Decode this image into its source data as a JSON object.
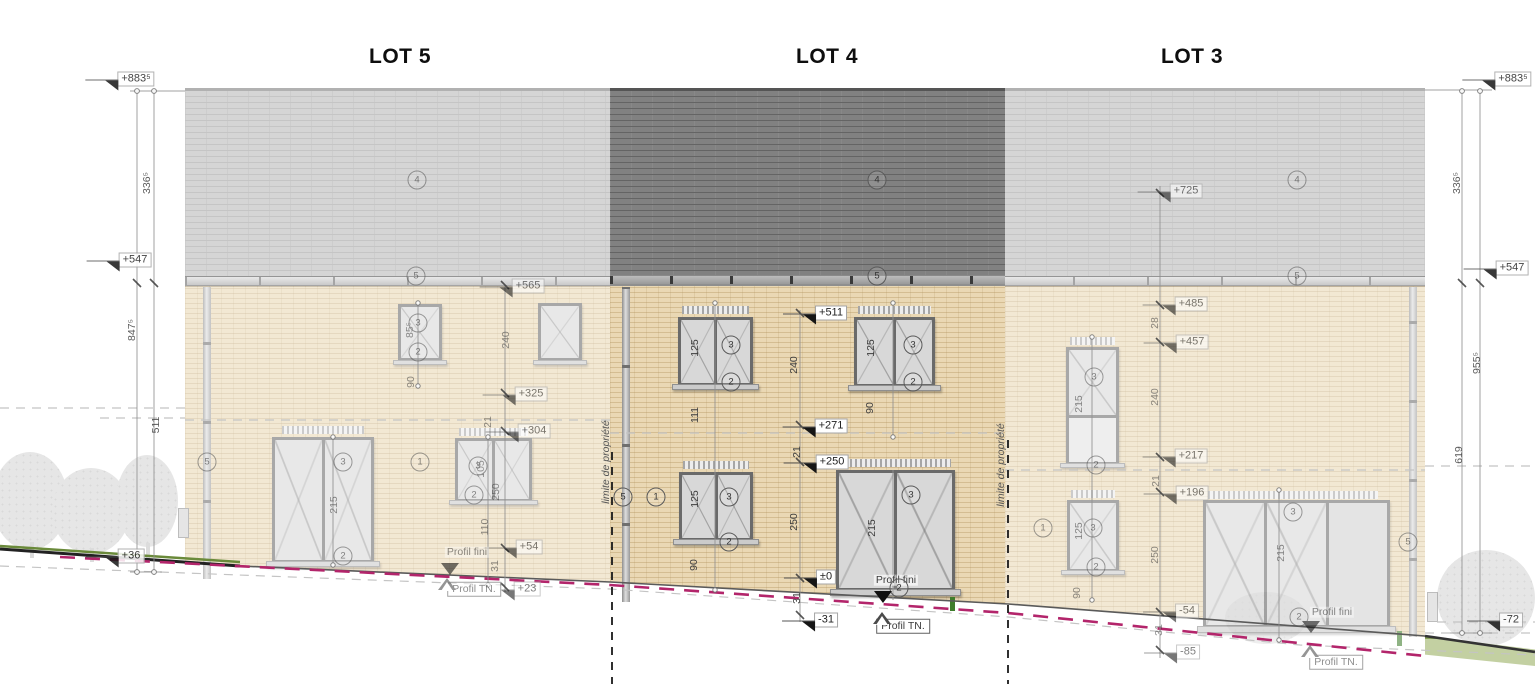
{
  "lots": [
    {
      "label": "LOT 5"
    },
    {
      "label": "LOT 4"
    },
    {
      "label": "LOT 3"
    }
  ],
  "colors": {
    "wall_brick": "#ead8b4",
    "roof_light": "#cbcbcb",
    "roof_dark_lot4": "#818181",
    "frame_gray": "#6a6a6a",
    "terrain_tn_magenta": "#b3256b",
    "grass_green": "#c3d0a2",
    "boundary_black": "#1a1a1a"
  },
  "annotations": {
    "left_margin": [
      {
        "t": "+883⁵",
        "x": 136,
        "y": 79,
        "k": "flag"
      },
      {
        "t": "336⁵",
        "x": 147,
        "y": 183,
        "k": "v"
      },
      {
        "t": "+547",
        "x": 135,
        "y": 260,
        "k": "flag"
      },
      {
        "t": "847⁵",
        "x": 132,
        "y": 330,
        "k": "v"
      },
      {
        "t": "511",
        "x": 156,
        "y": 425,
        "k": "v"
      },
      {
        "t": "+36",
        "x": 131,
        "y": 556,
        "k": "flag"
      }
    ],
    "right_margin": [
      {
        "t": "+883⁵",
        "x": 1513,
        "y": 79,
        "k": "flag"
      },
      {
        "t": "336⁵",
        "x": 1457,
        "y": 183,
        "k": "v"
      },
      {
        "t": "+547",
        "x": 1512,
        "y": 268,
        "k": "flag"
      },
      {
        "t": "955⁵",
        "x": 1477,
        "y": 363,
        "k": "v"
      },
      {
        "t": "619",
        "x": 1459,
        "y": 455,
        "k": "v"
      },
      {
        "t": "-72",
        "x": 1511,
        "y": 620,
        "k": "flag"
      }
    ],
    "lot5": [
      {
        "t": "+565",
        "x": 528,
        "y": 286,
        "k": "flag"
      },
      {
        "t": "240",
        "x": 506,
        "y": 340,
        "k": "v"
      },
      {
        "t": "+325",
        "x": 531,
        "y": 394,
        "k": "flag"
      },
      {
        "t": "21",
        "x": 488,
        "y": 422,
        "k": "v"
      },
      {
        "t": "+304",
        "x": 534,
        "y": 431,
        "k": "flag"
      },
      {
        "t": "250",
        "x": 496,
        "y": 492,
        "k": "v"
      },
      {
        "t": "110",
        "x": 485,
        "y": 527,
        "k": "v"
      },
      {
        "t": "+54",
        "x": 529,
        "y": 547,
        "k": "flag"
      },
      {
        "t": "31",
        "x": 495,
        "y": 566,
        "k": "v"
      },
      {
        "t": "Profil fini",
        "x": 467,
        "y": 552,
        "k": "h"
      },
      {
        "t": "+23",
        "x": 527,
        "y": 589,
        "k": "flag"
      },
      {
        "t": "Profil TN.",
        "x": 474,
        "y": 589,
        "k": "hb"
      },
      {
        "t": "85⁵",
        "x": 410,
        "y": 330,
        "k": "v"
      },
      {
        "t": "90",
        "x": 411,
        "y": 382,
        "k": "v"
      },
      {
        "t": "215",
        "x": 334,
        "y": 505,
        "k": "v"
      },
      {
        "t": "105",
        "x": 481,
        "y": 469,
        "k": "v"
      },
      {
        "t": "4",
        "x": 417,
        "y": 180,
        "k": "c"
      },
      {
        "t": "5",
        "x": 416,
        "y": 276,
        "k": "c"
      },
      {
        "t": "5",
        "x": 207,
        "y": 462,
        "k": "c"
      },
      {
        "t": "1",
        "x": 420,
        "y": 462,
        "k": "c"
      },
      {
        "t": "3",
        "x": 418,
        "y": 323,
        "k": "c"
      },
      {
        "t": "2",
        "x": 418,
        "y": 352,
        "k": "c"
      },
      {
        "t": "3",
        "x": 478,
        "y": 466,
        "k": "c"
      },
      {
        "t": "2",
        "x": 474,
        "y": 495,
        "k": "c"
      },
      {
        "t": "3",
        "x": 343,
        "y": 462,
        "k": "c"
      },
      {
        "t": "2",
        "x": 343,
        "y": 556,
        "k": "c"
      },
      {
        "x": 450,
        "y": 569,
        "k": "ad"
      },
      {
        "x": 447,
        "y": 584,
        "k": "au"
      }
    ],
    "lot4": [
      {
        "t": "+511",
        "x": 831,
        "y": 313,
        "k": "flag"
      },
      {
        "t": "240",
        "x": 794,
        "y": 365,
        "k": "v"
      },
      {
        "t": "+271",
        "x": 831,
        "y": 426,
        "k": "flag"
      },
      {
        "t": "21",
        "x": 797,
        "y": 452,
        "k": "v"
      },
      {
        "t": "+250",
        "x": 832,
        "y": 462,
        "k": "flag"
      },
      {
        "t": "250",
        "x": 794,
        "y": 522,
        "k": "v"
      },
      {
        "t": "±0",
        "x": 826,
        "y": 577,
        "k": "flag"
      },
      {
        "t": "31",
        "x": 797,
        "y": 598,
        "k": "v"
      },
      {
        "t": "-31",
        "x": 826,
        "y": 620,
        "k": "flag"
      },
      {
        "t": "Profil fini",
        "x": 896,
        "y": 580,
        "k": "h"
      },
      {
        "t": "Profil TN.",
        "x": 903,
        "y": 626,
        "k": "hb"
      },
      {
        "t": "125",
        "x": 695,
        "y": 348,
        "k": "v"
      },
      {
        "t": "111",
        "x": 695,
        "y": 415,
        "k": "v"
      },
      {
        "t": "125",
        "x": 695,
        "y": 499,
        "k": "v"
      },
      {
        "t": "90",
        "x": 694,
        "y": 565,
        "k": "v"
      },
      {
        "t": "125",
        "x": 871,
        "y": 348,
        "k": "v"
      },
      {
        "t": "90",
        "x": 870,
        "y": 408,
        "k": "v"
      },
      {
        "t": "215",
        "x": 872,
        "y": 528,
        "k": "v"
      },
      {
        "t": "limite de propriété",
        "x": 606,
        "y": 462,
        "k": "v",
        "it": true
      },
      {
        "t": "limite de propriété",
        "x": 1001,
        "y": 465,
        "k": "v",
        "it": true
      },
      {
        "t": "4",
        "x": 877,
        "y": 180,
        "k": "c"
      },
      {
        "t": "5",
        "x": 877,
        "y": 276,
        "k": "c"
      },
      {
        "t": "5",
        "x": 623,
        "y": 497,
        "k": "c"
      },
      {
        "t": "1",
        "x": 656,
        "y": 497,
        "k": "c"
      },
      {
        "t": "3",
        "x": 731,
        "y": 345,
        "k": "c"
      },
      {
        "t": "2",
        "x": 731,
        "y": 382,
        "k": "c"
      },
      {
        "t": "3",
        "x": 913,
        "y": 345,
        "k": "c"
      },
      {
        "t": "2",
        "x": 913,
        "y": 382,
        "k": "c"
      },
      {
        "t": "3",
        "x": 729,
        "y": 497,
        "k": "c"
      },
      {
        "t": "2",
        "x": 729,
        "y": 542,
        "k": "c"
      },
      {
        "t": "3",
        "x": 911,
        "y": 495,
        "k": "c"
      },
      {
        "t": "2",
        "x": 899,
        "y": 588,
        "k": "c"
      },
      {
        "x": 883,
        "y": 597,
        "k": "ad"
      },
      {
        "x": 882,
        "y": 618,
        "k": "au"
      }
    ],
    "lot3": [
      {
        "t": "+725",
        "x": 1186,
        "y": 191,
        "k": "flag"
      },
      {
        "t": "+485",
        "x": 1191,
        "y": 304,
        "k": "flag"
      },
      {
        "t": "28",
        "x": 1155,
        "y": 323,
        "k": "v"
      },
      {
        "t": "+457",
        "x": 1192,
        "y": 342,
        "k": "flag"
      },
      {
        "t": "240",
        "x": 1155,
        "y": 397,
        "k": "v"
      },
      {
        "t": "+217",
        "x": 1191,
        "y": 456,
        "k": "flag"
      },
      {
        "t": "21",
        "x": 1156,
        "y": 481,
        "k": "v"
      },
      {
        "t": "+196",
        "x": 1192,
        "y": 493,
        "k": "flag"
      },
      {
        "t": "250",
        "x": 1155,
        "y": 555,
        "k": "v"
      },
      {
        "t": "-54",
        "x": 1187,
        "y": 611,
        "k": "flag"
      },
      {
        "t": "31",
        "x": 1159,
        "y": 630,
        "k": "v"
      },
      {
        "t": "-85",
        "x": 1188,
        "y": 652,
        "k": "flag"
      },
      {
        "t": "Profil fini",
        "x": 1332,
        "y": 612,
        "k": "h"
      },
      {
        "t": "Profil TN.",
        "x": 1336,
        "y": 662,
        "k": "hb"
      },
      {
        "t": "215",
        "x": 1079,
        "y": 404,
        "k": "v"
      },
      {
        "t": "125",
        "x": 1079,
        "y": 531,
        "k": "v"
      },
      {
        "t": "90",
        "x": 1077,
        "y": 593,
        "k": "v"
      },
      {
        "t": "215",
        "x": 1281,
        "y": 553,
        "k": "v"
      },
      {
        "t": "4",
        "x": 1297,
        "y": 180,
        "k": "c"
      },
      {
        "t": "5",
        "x": 1297,
        "y": 276,
        "k": "c"
      },
      {
        "t": "5",
        "x": 1408,
        "y": 542,
        "k": "c"
      },
      {
        "t": "1",
        "x": 1043,
        "y": 528,
        "k": "c"
      },
      {
        "t": "3",
        "x": 1094,
        "y": 377,
        "k": "c"
      },
      {
        "t": "2",
        "x": 1096,
        "y": 465,
        "k": "c"
      },
      {
        "t": "3",
        "x": 1093,
        "y": 528,
        "k": "c"
      },
      {
        "t": "2",
        "x": 1096,
        "y": 567,
        "k": "c"
      },
      {
        "t": "3",
        "x": 1293,
        "y": 512,
        "k": "c"
      },
      {
        "t": "2",
        "x": 1299,
        "y": 617,
        "k": "c"
      },
      {
        "x": 1311,
        "y": 627,
        "k": "ad"
      },
      {
        "x": 1310,
        "y": 651,
        "k": "au"
      }
    ]
  }
}
